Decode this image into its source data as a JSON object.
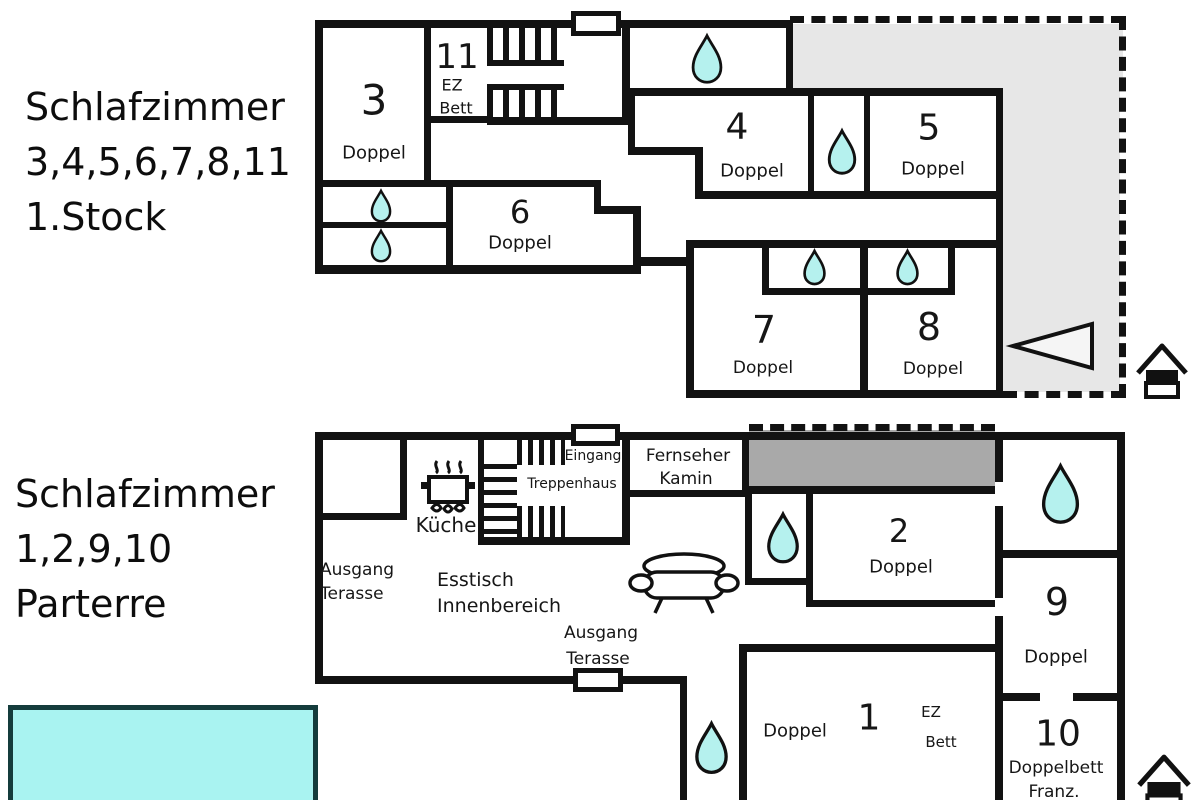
{
  "colors": {
    "wall": "#121212",
    "water_drop": "#b5f1ee",
    "pool": "#a9f3f1",
    "upper_terrace_gray": "#e7e7e7",
    "lower_gray_band": "#a9a9a9"
  },
  "floor1": {
    "title_line1": "Schlafzimmer",
    "title_line2": "3,4,5,6,7,8,11",
    "title_line3": "1.Stock",
    "rooms": {
      "r3": {
        "num": "3",
        "type": "Doppel"
      },
      "r11": {
        "num": "11",
        "type_line1": "EZ",
        "type_line2": "Bett"
      },
      "r4": {
        "num": "4",
        "type": "Doppel"
      },
      "r5": {
        "num": "5",
        "type": "Doppel"
      },
      "r6": {
        "num": "6",
        "type": "Doppel"
      },
      "r7": {
        "num": "7",
        "type": "Doppel"
      },
      "r8": {
        "num": "8",
        "type": "Doppel"
      }
    }
  },
  "floor0": {
    "title_line1": "Schlafzimmer",
    "title_line2": "1,2,9,10",
    "title_line3": "Parterre",
    "labels": {
      "kitchen": "Küche",
      "entrance": "Eingang",
      "stairwell": "Treppenhaus",
      "tv": "Fernseher",
      "fireplace": "Kamin",
      "exit_terrace_left_line1": "Ausgang",
      "exit_terrace_left_line2": "Terasse",
      "dining_line1": "Esstisch",
      "dining_line2": "Innenbereich",
      "exit_terrace_bottom_line1": "Ausgang",
      "exit_terrace_bottom_line2": "Terasse"
    },
    "rooms": {
      "r1": {
        "num": "1",
        "type": "Doppel",
        "extra_line1": "EZ",
        "extra_line2": "Bett"
      },
      "r2": {
        "num": "2",
        "type": "Doppel"
      },
      "r9": {
        "num": "9",
        "type": "Doppel"
      },
      "r10": {
        "num": "10",
        "type_line1": "Doppelbett",
        "type_line2": "Franz."
      }
    }
  }
}
